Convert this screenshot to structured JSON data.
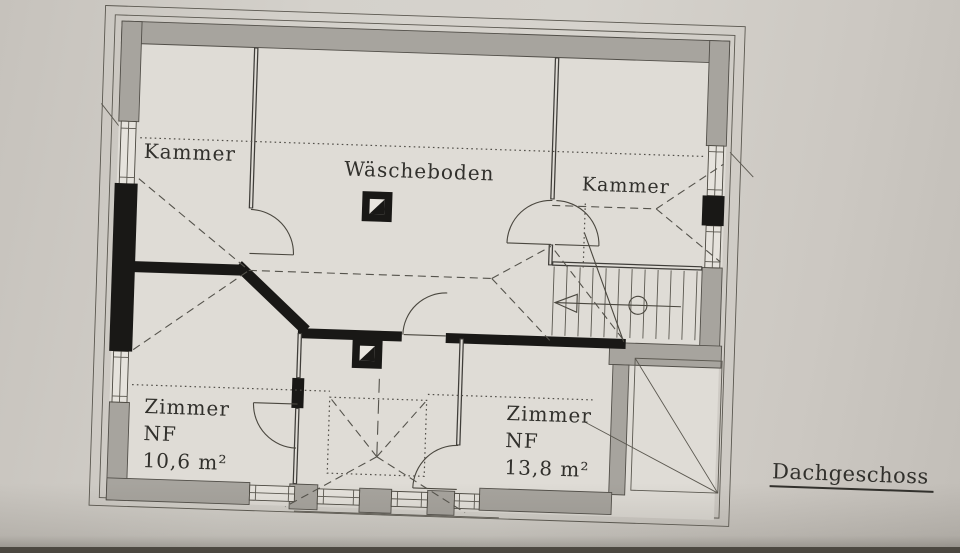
{
  "title": {
    "label": "Dachgeschoss"
  },
  "rooms": {
    "kammer_left": "Kammer",
    "waescheboden": "Wäscheboden",
    "kammer_right": "Kammer",
    "zimmer_left": {
      "line1": "Zimmer",
      "line2": "NF",
      "line3": "10,6 m²"
    },
    "zimmer_right": {
      "line1": "Zimmer",
      "line2": "NF",
      "line3": "13,8 m²"
    }
  },
  "symbols": {
    "chimney": "chimney-flue-symbol",
    "stair_arrow": "stair-direction-down-arrow"
  },
  "colors": {
    "background": "#cfccc6",
    "paper": "#d9d6d0",
    "floor": "#dfdcd6",
    "wall_gray": "#a7a49e",
    "wall_black": "#191816",
    "line": "#4a473f",
    "text": "#31302c",
    "photo_edge": "#4e4b44"
  }
}
